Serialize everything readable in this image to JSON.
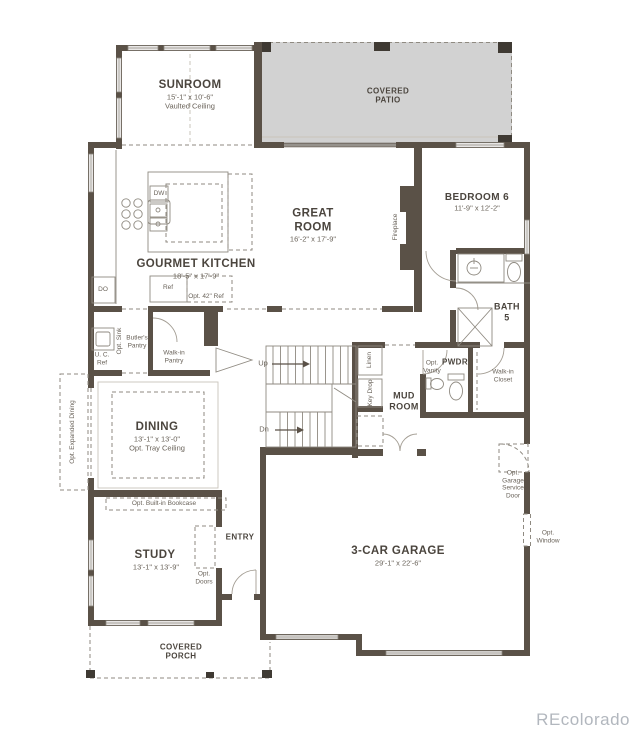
{
  "colors": {
    "wall": "#5a5147",
    "post": "#3f3a33",
    "patio": "#d2d2d2",
    "line": "#8f8a81",
    "ink": "#4b453e",
    "ink2": "#6a635a",
    "wm": "#b2b7be"
  },
  "labels": {
    "sunroom_name": "SUNROOM",
    "sunroom_dims": "15'-1\" x 10'-6\"",
    "sunroom_note": "Vaulted Ceiling",
    "covered_patio": "COVERED PATIO",
    "great_room_name": "GREAT ROOM",
    "great_room_dims": "16'-2\" x 17'-9\"",
    "fireplace": "Fireplace",
    "bedroom6_name": "BEDROOM 6",
    "bedroom6_dims": "11'-9\" x 12'-2\"",
    "kitchen_name": "GOURMET KITCHEN",
    "kitchen_dims": "18'-5\" x 17'-9\"",
    "dw": "DW",
    "ref": "Ref",
    "opt_42_ref": "Opt. 42\" Ref",
    "do": "DO",
    "opt_sink": "Opt. Sink",
    "uc_ref": "U. C. Ref",
    "butlers_pantry": "Butler's Pantry",
    "walkin_pantry": "Walk-in Pantry",
    "bath5": "BATH 5",
    "pwdr": "PWDR",
    "opt_vanity": "Opt. Vanity",
    "walkin_closet": "Walk-in Closet",
    "mud_room": "MUD ROOM",
    "linen": "Linen",
    "key_drop": "Key Drop",
    "up": "Up",
    "dn": "Dn",
    "dining_name": "DINING",
    "dining_dims": "13'-1\" x 13'-0\"",
    "dining_note": "Opt. Tray Ceiling",
    "opt_expanded_dining": "Opt. Expanded Dining",
    "opt_builtin_bookcase": "Opt. Built-in Bookcase",
    "study_name": "STUDY",
    "study_dims": "13'-1\" x 13'-9\"",
    "opt_doors": "Opt. Doors",
    "entry": "ENTRY",
    "garage_name": "3-CAR GARAGE",
    "garage_dims": "29'-1\" x 22'-6\"",
    "opt_garage_service_door": "Opt. Garage Service Door",
    "opt_window": "Opt. Window",
    "covered_porch": "COVERED PORCH",
    "watermark": "REcolorado"
  }
}
